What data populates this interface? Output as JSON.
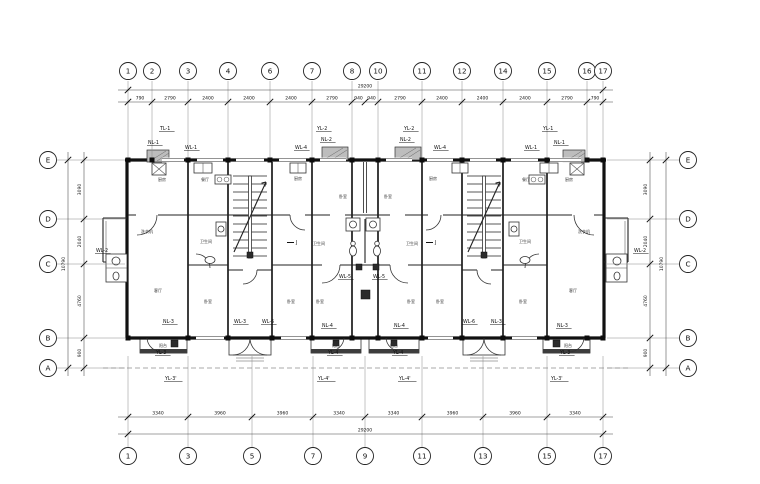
{
  "axes": {
    "top": [
      {
        "n": "1",
        "x": 128
      },
      {
        "n": "2",
        "x": 152
      },
      {
        "n": "3",
        "x": 188
      },
      {
        "n": "4",
        "x": 228
      },
      {
        "n": "6",
        "x": 270
      },
      {
        "n": "7",
        "x": 312
      },
      {
        "n": "8",
        "x": 352
      },
      {
        "n": "10",
        "x": 378
      },
      {
        "n": "11",
        "x": 422
      },
      {
        "n": "12",
        "x": 462
      },
      {
        "n": "14",
        "x": 503
      },
      {
        "n": "15",
        "x": 547
      },
      {
        "n": "16",
        "x": 587
      },
      {
        "n": "17",
        "x": 603
      }
    ],
    "bottom": [
      {
        "n": "1",
        "x": 128
      },
      {
        "n": "3",
        "x": 188
      },
      {
        "n": "5",
        "x": 252
      },
      {
        "n": "7",
        "x": 313
      },
      {
        "n": "9",
        "x": 365
      },
      {
        "n": "11",
        "x": 422
      },
      {
        "n": "13",
        "x": 483
      },
      {
        "n": "15",
        "x": 547
      },
      {
        "n": "17",
        "x": 603
      }
    ],
    "left": [
      {
        "n": "E",
        "y": 160
      },
      {
        "n": "D",
        "y": 219
      },
      {
        "n": "C",
        "y": 264
      },
      {
        "n": "B",
        "y": 338
      },
      {
        "n": "A",
        "y": 368
      }
    ],
    "right": [
      {
        "n": "E",
        "y": 160
      },
      {
        "n": "D",
        "y": 219
      },
      {
        "n": "C",
        "y": 264
      },
      {
        "n": "B",
        "y": 338
      },
      {
        "n": "A",
        "y": 368
      }
    ]
  },
  "dimensions": {
    "top_overall": "29200",
    "bottom_overall": "29200",
    "side_overall": "10790",
    "top_segments": [
      {
        "text": "790",
        "from": 128,
        "to": 152
      },
      {
        "text": "2790",
        "from": 152,
        "to": 188
      },
      {
        "text": "2400",
        "from": 188,
        "to": 228
      },
      {
        "text": "2400",
        "from": 228,
        "to": 270
      },
      {
        "text": "2400",
        "from": 270,
        "to": 312
      },
      {
        "text": "2790",
        "from": 312,
        "to": 352
      },
      {
        "text": "940",
        "from": 352,
        "to": 365
      },
      {
        "text": "940",
        "from": 365,
        "to": 378
      },
      {
        "text": "2790",
        "from": 378,
        "to": 422
      },
      {
        "text": "2400",
        "from": 422,
        "to": 462
      },
      {
        "text": "2400",
        "from": 462,
        "to": 503
      },
      {
        "text": "2400",
        "from": 503,
        "to": 547
      },
      {
        "text": "2790",
        "from": 547,
        "to": 587
      },
      {
        "text": "790",
        "from": 587,
        "to": 603
      }
    ],
    "bottom_segments": [
      {
        "text": "3340",
        "from": 128,
        "to": 188
      },
      {
        "text": "3960",
        "from": 188,
        "to": 252
      },
      {
        "text": "3960",
        "from": 252,
        "to": 313
      },
      {
        "text": "3340",
        "from": 313,
        "to": 365
      },
      {
        "text": "3340",
        "from": 365,
        "to": 422
      },
      {
        "text": "3960",
        "from": 422,
        "to": 483
      },
      {
        "text": "3960",
        "from": 483,
        "to": 547
      },
      {
        "text": "3340",
        "from": 547,
        "to": 603
      }
    ],
    "side_segments": [
      {
        "text": "3090",
        "from": 160,
        "to": 219
      },
      {
        "text": "2040",
        "from": 219,
        "to": 264
      },
      {
        "text": "4760",
        "from": 264,
        "to": 338
      },
      {
        "text": "900",
        "from": 338,
        "to": 368
      }
    ]
  },
  "riser_labels": [
    {
      "text": "TL-1",
      "x": 160,
      "y": 130
    },
    {
      "text": "NL-1",
      "x": 148,
      "y": 144
    },
    {
      "text": "WL-1",
      "x": 185,
      "y": 149
    },
    {
      "text": "WL-4",
      "x": 295,
      "y": 149
    },
    {
      "text": "YL-2",
      "x": 317,
      "y": 130
    },
    {
      "text": "NL-2",
      "x": 321,
      "y": 141
    },
    {
      "text": "YL-2",
      "x": 404,
      "y": 130
    },
    {
      "text": "NL-2",
      "x": 400,
      "y": 141
    },
    {
      "text": "WL-4",
      "x": 434,
      "y": 149
    },
    {
      "text": "WL-1",
      "x": 525,
      "y": 149
    },
    {
      "text": "NL-1",
      "x": 554,
      "y": 144
    },
    {
      "text": "YL-1",
      "x": 543,
      "y": 130
    },
    {
      "text": "WL-2",
      "x": 96,
      "y": 252
    },
    {
      "text": "WL-2",
      "x": 634,
      "y": 252
    },
    {
      "text": "WL-5",
      "x": 339,
      "y": 278
    },
    {
      "text": "WL-5",
      "x": 373,
      "y": 278
    },
    {
      "text": "NL-3",
      "x": 163,
      "y": 323
    },
    {
      "text": "YL-3",
      "x": 156,
      "y": 354
    },
    {
      "text": "YL-3'",
      "x": 165,
      "y": 380
    },
    {
      "text": "WL-3",
      "x": 234,
      "y": 323
    },
    {
      "text": "WL-6",
      "x": 262,
      "y": 323
    },
    {
      "text": "NL-4",
      "x": 322,
      "y": 327
    },
    {
      "text": "YL-4",
      "x": 328,
      "y": 354
    },
    {
      "text": "YL-4'",
      "x": 318,
      "y": 380
    },
    {
      "text": "NL-4",
      "x": 394,
      "y": 327
    },
    {
      "text": "YL-4",
      "x": 393,
      "y": 354
    },
    {
      "text": "YL-4'",
      "x": 399,
      "y": 380
    },
    {
      "text": "WL-6",
      "x": 463,
      "y": 323
    },
    {
      "text": "NL-3",
      "x": 491,
      "y": 323
    },
    {
      "text": "NL-3",
      "x": 557,
      "y": 327
    },
    {
      "text": "YL-3",
      "x": 560,
      "y": 354
    },
    {
      "text": "YL-3'",
      "x": 551,
      "y": 380
    }
  ],
  "room_labels": [
    {
      "text": "厨房",
      "x": 162,
      "y": 181
    },
    {
      "text": "餐厅",
      "x": 205,
      "y": 181
    },
    {
      "text": "厨房",
      "x": 298,
      "y": 180
    },
    {
      "text": "卧室",
      "x": 343,
      "y": 198
    },
    {
      "text": "卧室",
      "x": 388,
      "y": 198
    },
    {
      "text": "厨房",
      "x": 433,
      "y": 180
    },
    {
      "text": "餐厅",
      "x": 526,
      "y": 181
    },
    {
      "text": "厨房",
      "x": 569,
      "y": 181
    },
    {
      "text": "洗衣机",
      "x": 147,
      "y": 233
    },
    {
      "text": "卫生间",
      "x": 206,
      "y": 243
    },
    {
      "text": "卫生间",
      "x": 319,
      "y": 245
    },
    {
      "text": "卫生间",
      "x": 412,
      "y": 245
    },
    {
      "text": "卫生间",
      "x": 525,
      "y": 243
    },
    {
      "text": "洗衣机",
      "x": 584,
      "y": 233
    },
    {
      "text": "客厅",
      "x": 158,
      "y": 292
    },
    {
      "text": "卧室",
      "x": 208,
      "y": 303
    },
    {
      "text": "卧室",
      "x": 291,
      "y": 303
    },
    {
      "text": "卧室",
      "x": 320,
      "y": 303
    },
    {
      "text": "卧室",
      "x": 411,
      "y": 303
    },
    {
      "text": "卧室",
      "x": 440,
      "y": 303
    },
    {
      "text": "卧室",
      "x": 523,
      "y": 303
    },
    {
      "text": "客厅",
      "x": 573,
      "y": 292
    },
    {
      "text": "阳台",
      "x": 163,
      "y": 347
    },
    {
      "text": "阳台",
      "x": 336,
      "y": 347
    },
    {
      "text": "阳台",
      "x": 394,
      "y": 347
    },
    {
      "text": "阳台",
      "x": 568,
      "y": 347
    }
  ],
  "section_marks": [
    {
      "text": "J",
      "x": 296,
      "y": 244
    },
    {
      "text": "J",
      "x": 435,
      "y": 244
    }
  ]
}
